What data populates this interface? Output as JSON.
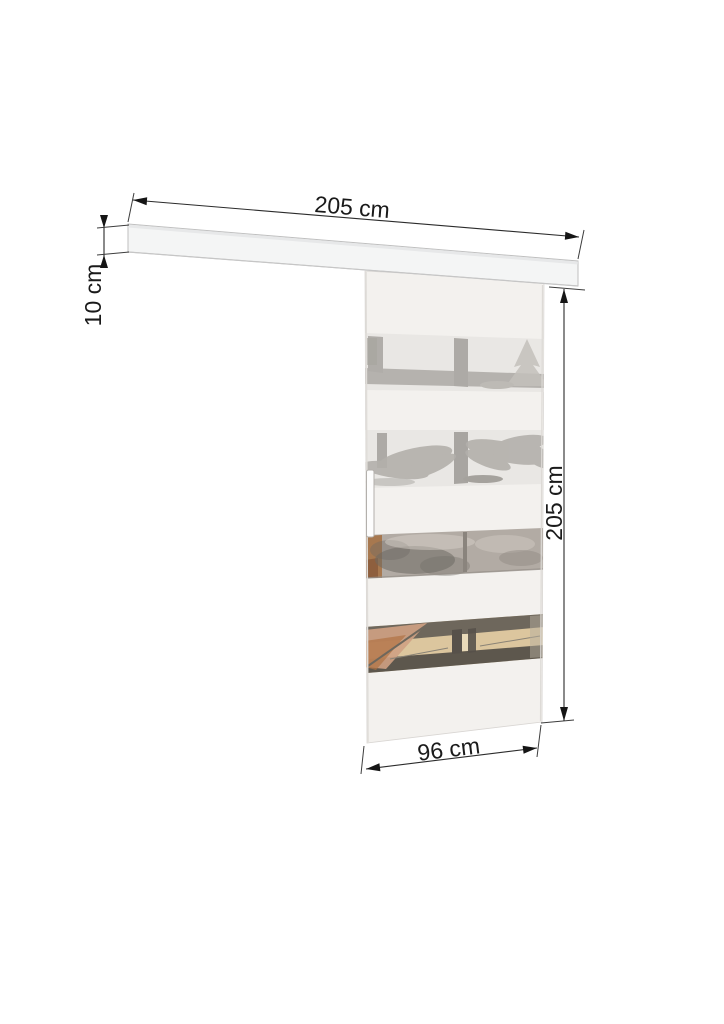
{
  "dims": {
    "rail_width": {
      "label": "205 cm",
      "value": 205,
      "unit": "cm"
    },
    "rail_height": {
      "label": "10 cm",
      "value": 10,
      "unit": "cm"
    },
    "door_height": {
      "label": "205 cm",
      "value": 205,
      "unit": "cm"
    },
    "door_width": {
      "label": "96 cm",
      "value": 96,
      "unit": "cm"
    }
  },
  "colors": {
    "background": "#ffffff",
    "dimension_line": "#2b2b2b",
    "label_text": "#1a1a1a",
    "rail_fill": "#f4f5f5",
    "rail_edge": "#bfbfbf",
    "door_fill": "#f3f1ee",
    "door_edge": "#d9d6d3",
    "glass_stripe_light": "#e9e7e4",
    "glass_reflection_gray": "#b5b2ae",
    "glass_stripe_taupe": "#b2aba4",
    "glass_stripe_dark_band": "#6e675c",
    "glass_stripe_dark_band2": "#5d574d",
    "wood_tan": "#dcc69e",
    "wood_orange": "#a56f41",
    "handle_fill": "#fdfdfd"
  }
}
